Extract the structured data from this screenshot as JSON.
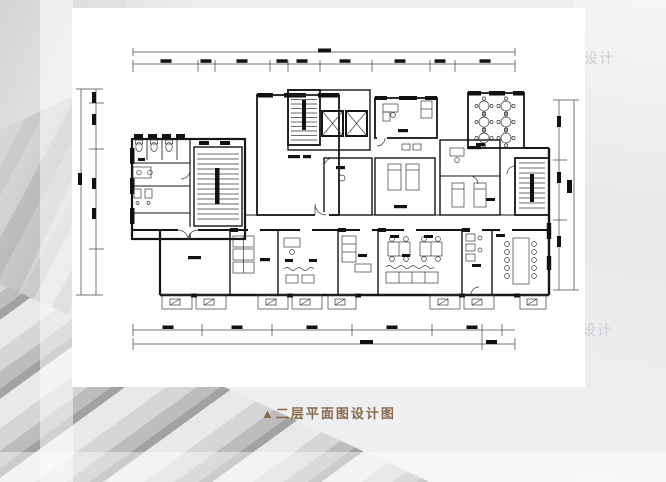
{
  "background": {
    "base_color": "#edeff1",
    "texture_colors": [
      "#a2a2a2",
      "#bdbdbd",
      "#d6d6d6",
      "#e9e9e9"
    ]
  },
  "card": {
    "background_color": "#ffffff"
  },
  "caption": {
    "marker": "▲",
    "title": "二层平面图设计图",
    "color": "#8a6a4a"
  },
  "watermark": {
    "text": "设计",
    "color": "#c9cacd"
  },
  "floor_plan": {
    "type": "architectural-floor-plan",
    "floor": "二层",
    "ink_color": "#141414",
    "paper_color": "#ffffff",
    "note": "CAD line drawing with dimension chains on all four sides; room labels and dimension figures are below legibility in the source image"
  }
}
